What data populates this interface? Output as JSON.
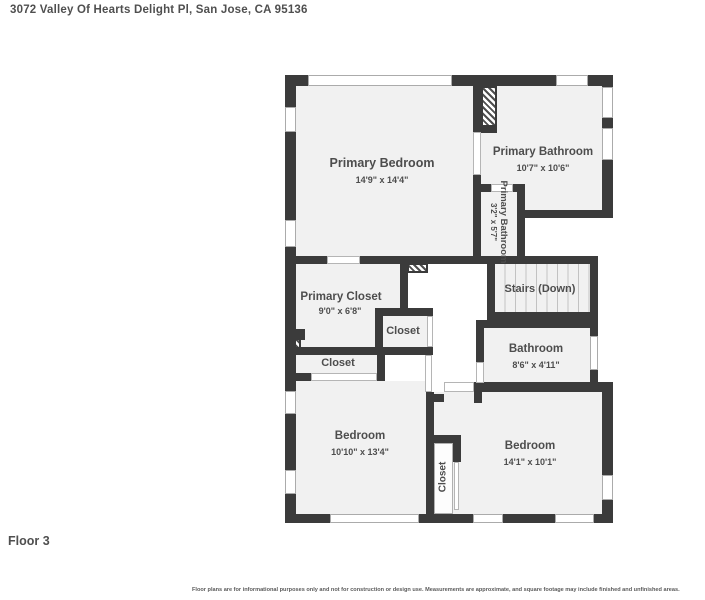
{
  "header": {
    "address": "3072 Valley Of Hearts Delight Pl, San Jose, CA 95136"
  },
  "floor_label": "Floor 3",
  "disclaimer": "Floor plans are for informational purposes only and not for construction or design use. Measurements are approximate, and square footage may include finished and unfinished areas.",
  "rooms": [
    {
      "id": "primary-bedroom",
      "name": "Primary Bedroom",
      "dims": "14'9\" x 14'4\""
    },
    {
      "id": "primary-bathroom",
      "name": "Primary Bathroom",
      "dims": "10'7\" x 10'6\""
    },
    {
      "id": "primary-bathroom-small",
      "name": "Primary Bathroom",
      "dims": "3'2\" x 5'7\""
    },
    {
      "id": "primary-closet",
      "name": "Primary Closet",
      "dims": "9'0\" x 6'8\""
    },
    {
      "id": "closet-mid",
      "name": "Closet",
      "dims": ""
    },
    {
      "id": "closet-left",
      "name": "Closet",
      "dims": ""
    },
    {
      "id": "stairs",
      "name": "Stairs (Down)",
      "dims": ""
    },
    {
      "id": "bathroom",
      "name": "Bathroom",
      "dims": "8'6\" x 4'11\""
    },
    {
      "id": "bedroom-left",
      "name": "Bedroom",
      "dims": "10'10\" x 13'4\""
    },
    {
      "id": "closet-bottom",
      "name": "Closet",
      "dims": ""
    },
    {
      "id": "bedroom-right",
      "name": "Bedroom",
      "dims": "14'1\" x 10'1\""
    }
  ],
  "colors": {
    "wall": "#3b3b3b",
    "floor": "#f1f1f1",
    "text": "#4d4d4d",
    "background": "#ffffff"
  }
}
